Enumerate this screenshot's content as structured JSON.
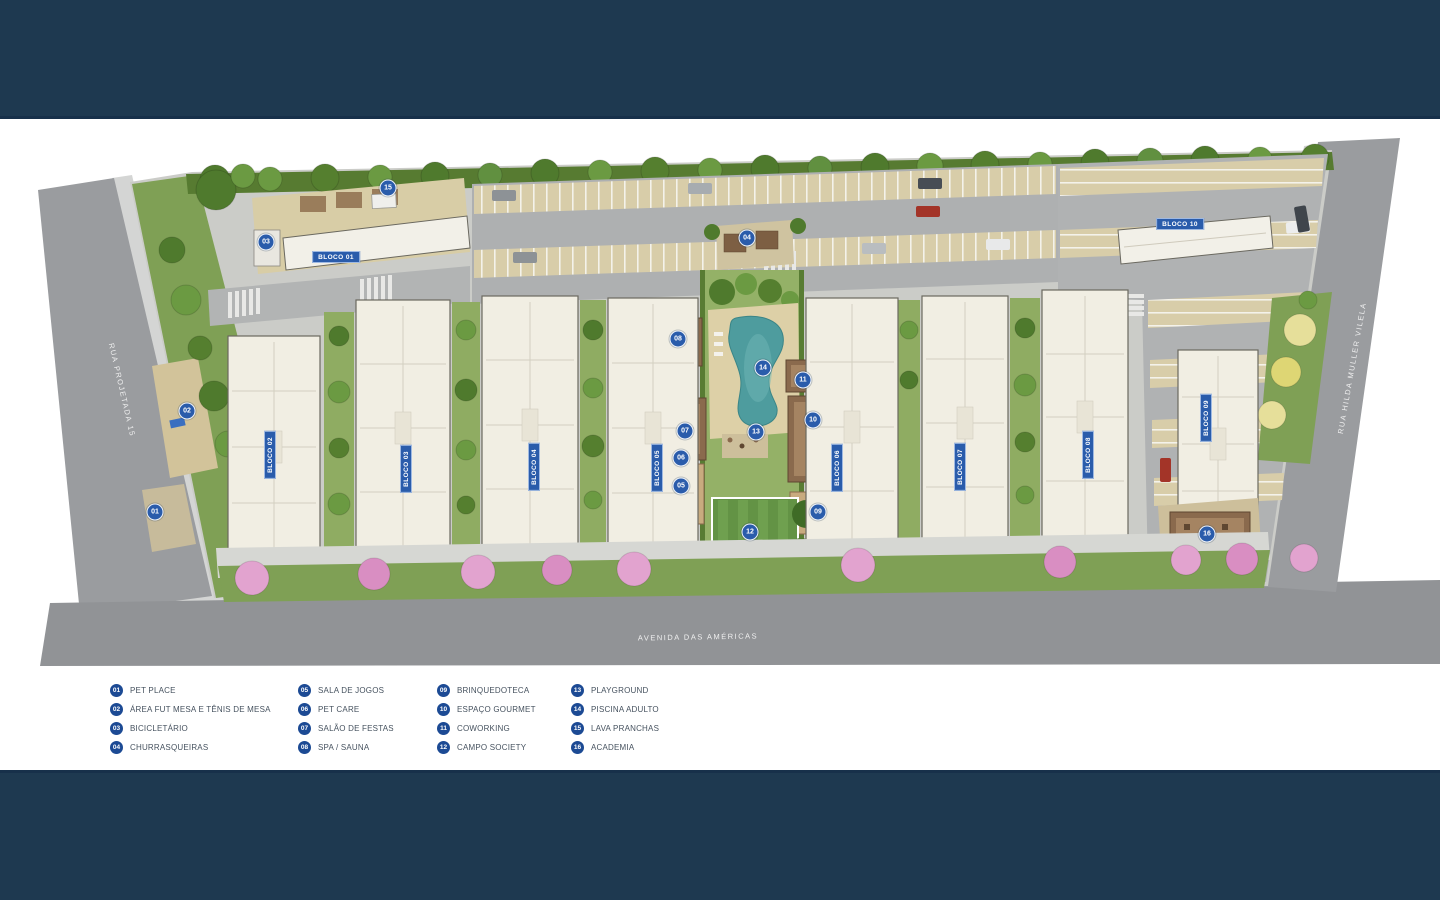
{
  "map": {
    "streets": {
      "left": "RUA PROJETADA 15",
      "bottom": "AVENIDA DAS AMÉRICAS",
      "right": "RUA HILDA MULLER VILELA"
    },
    "blocos": [
      "BLOCO 01",
      "BLOCO 02",
      "BLOCO 03",
      "BLOCO 04",
      "BLOCO 05",
      "BLOCO 06",
      "BLOCO 07",
      "BLOCO 08",
      "BLOCO 09",
      "BLOCO 10"
    ],
    "markers": [
      "01",
      "02",
      "03",
      "04",
      "05",
      "06",
      "07",
      "08",
      "09",
      "10",
      "11",
      "12",
      "13",
      "14",
      "15",
      "16"
    ]
  },
  "legend": {
    "columns": [
      {
        "items": [
          {
            "num": "01",
            "label": "PET PLACE"
          },
          {
            "num": "02",
            "label": "ÁREA FUT MESA E TÊNIS DE MESA"
          },
          {
            "num": "03",
            "label": "BICICLETÁRIO"
          },
          {
            "num": "04",
            "label": "CHURRASQUEIRAS"
          }
        ]
      },
      {
        "items": [
          {
            "num": "05",
            "label": "SALA DE JOGOS"
          },
          {
            "num": "06",
            "label": "PET CARE"
          },
          {
            "num": "07",
            "label": "SALÃO DE FESTAS"
          },
          {
            "num": "08",
            "label": "SPA / SAUNA"
          }
        ]
      },
      {
        "items": [
          {
            "num": "09",
            "label": "BRINQUEDOTECA"
          },
          {
            "num": "10",
            "label": "ESPAÇO GOURMET"
          },
          {
            "num": "11",
            "label": "COWORKING"
          },
          {
            "num": "12",
            "label": "CAMPO SOCIETY"
          }
        ]
      },
      {
        "items": [
          {
            "num": "13",
            "label": "PLAYGROUND"
          },
          {
            "num": "14",
            "label": "PISCINA ADULTO"
          },
          {
            "num": "15",
            "label": "LAVA PRANCHAS"
          },
          {
            "num": "16",
            "label": "ACADEMIA"
          }
        ]
      }
    ]
  },
  "colors": {
    "band_navy": "#1E3950",
    "marker_blue": "#2A5CAB",
    "legend_blue": "#1C4A94",
    "grass_green": "#7FA055",
    "pool_teal": "#4E9C9E"
  }
}
